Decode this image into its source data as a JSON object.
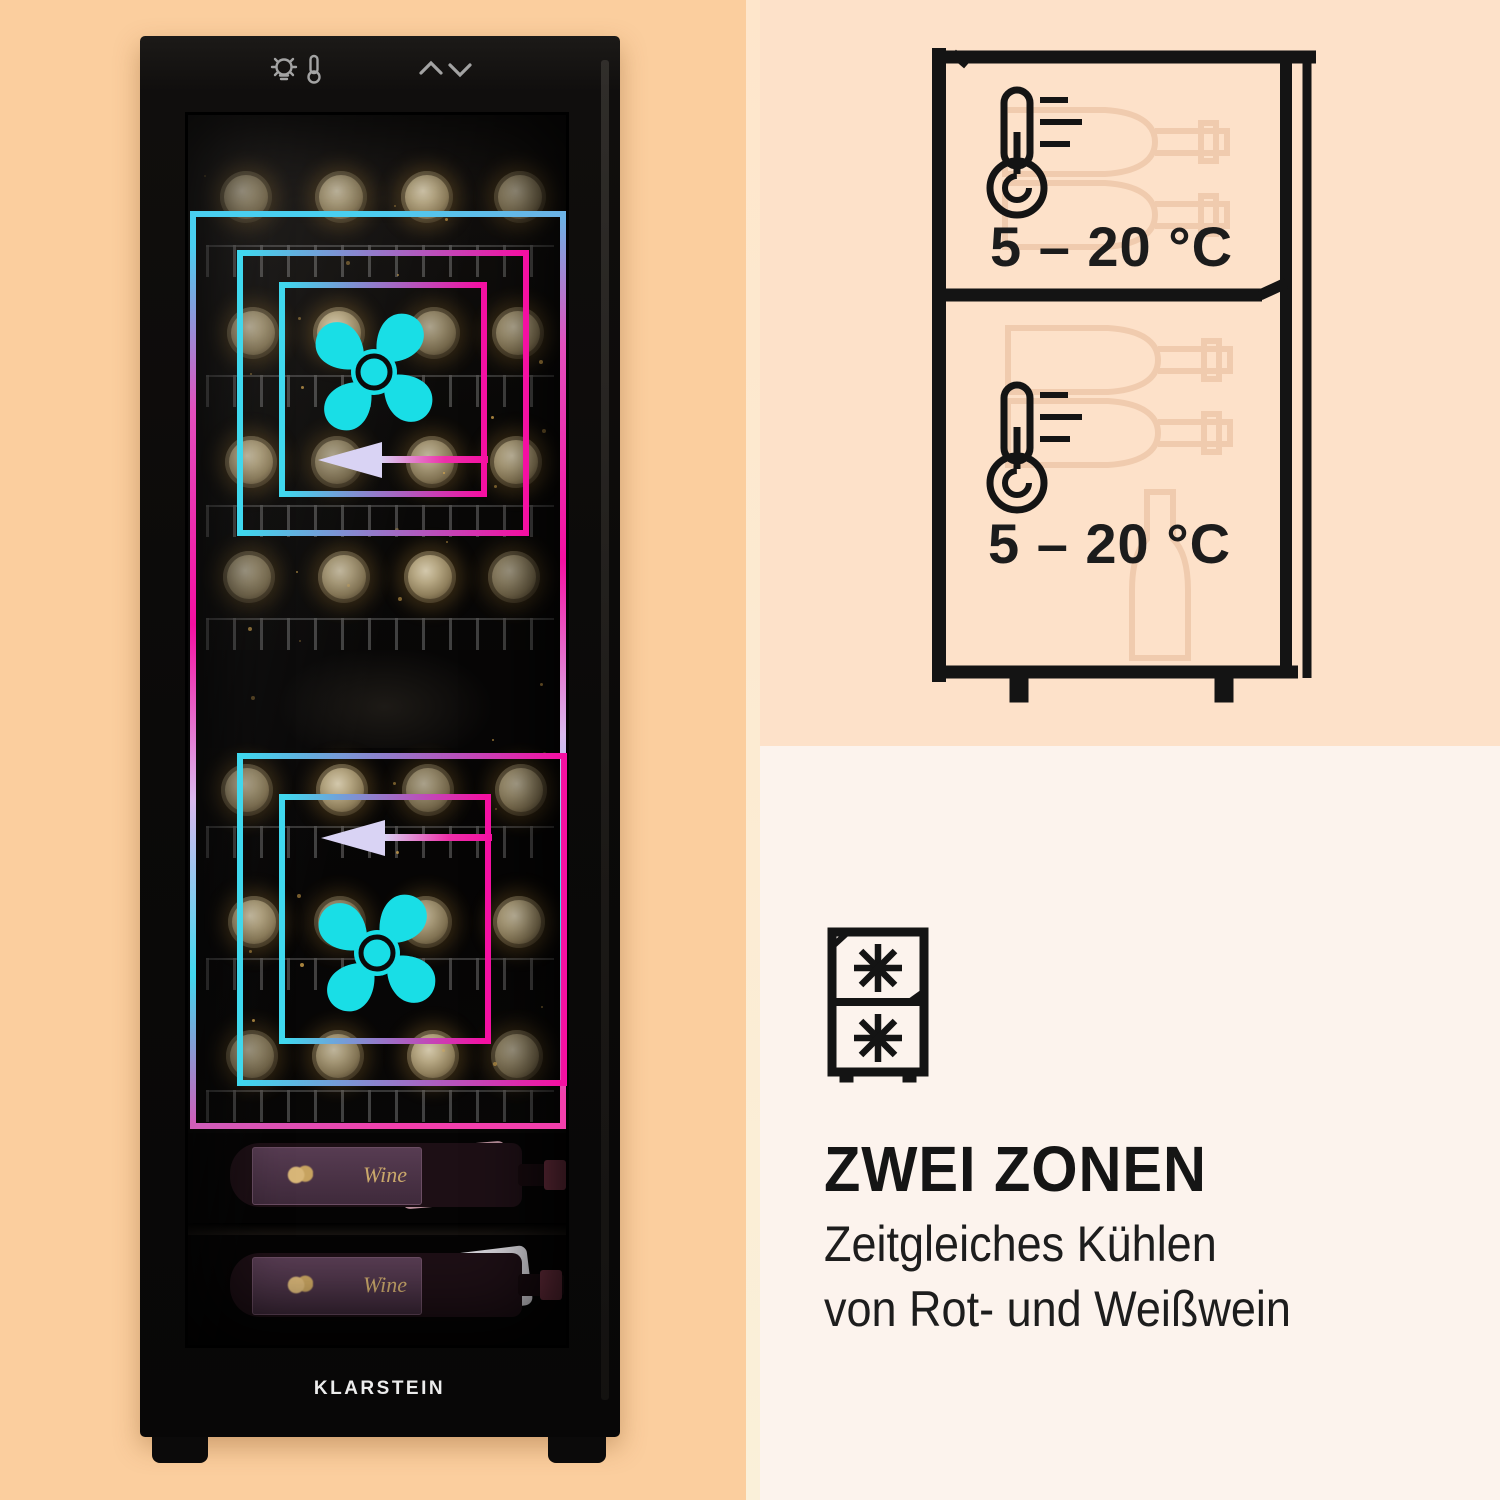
{
  "layout_colors": {
    "left_panel_bg": "#FBCE9E",
    "top_right_panel_bg": "#FDE1C9",
    "bottom_right_panel_bg": "#FCF3ED",
    "neon_cyan": "#3FD8EE",
    "neon_magenta": "#F50FA2",
    "arrow_lavender": "#D9D3F4",
    "fan_cyan": "#19DEE6"
  },
  "fridge_photo": {
    "brand": "KLARSTEIN",
    "bottle_label": "Wine",
    "control_icons": [
      "light-bulb-icon",
      "thermometer-icon",
      "chevron-up-icon",
      "chevron-down-icon"
    ]
  },
  "temperature_diagram": {
    "icon": "two-zone-wine-fridge-outline",
    "zones": [
      {
        "temp_range": "5 – 20 °C"
      },
      {
        "temp_range": "5 – 20 °C"
      }
    ]
  },
  "feature": {
    "icon_name": "two-zone-freezer-snowflakes-icon",
    "title": "ZWEI ZONEN",
    "description_line1": "Zeitgleiches Kühlen",
    "description_line2": "von Rot- und Weißwein"
  }
}
